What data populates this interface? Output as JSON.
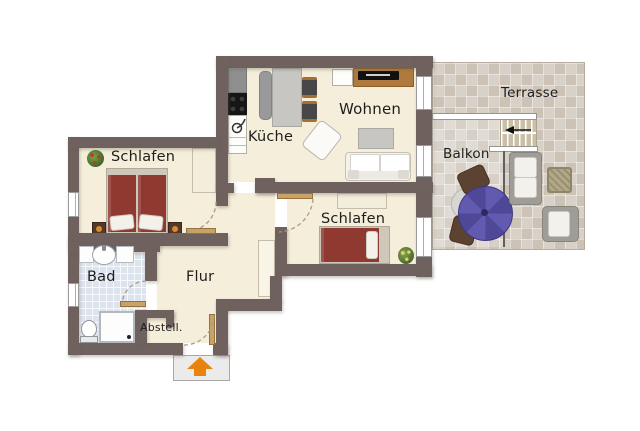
{
  "rooms": {
    "schlafen_links": "Schlafen",
    "kueche": "Küche",
    "wohnen": "Wohnen",
    "schlafen_rechts": "Schlafen",
    "bad": "Bad",
    "flur": "Flur",
    "abstell": "Abstell.",
    "balkon": "Balkon",
    "terrasse": "Terrasse"
  },
  "colors": {
    "wall": "#6e615e",
    "floor": "#f5eeda",
    "bath_floor": "#dde4ed",
    "terrace_tile": "#d3cbc0",
    "bed": "#8f3931",
    "wood": "#b07a3e",
    "door_wood": "#c9a265",
    "umbrella": "#5b53a7",
    "arrow_orange": "#e8830d"
  },
  "icons": {
    "entrance_arrow": "up-arrow"
  }
}
